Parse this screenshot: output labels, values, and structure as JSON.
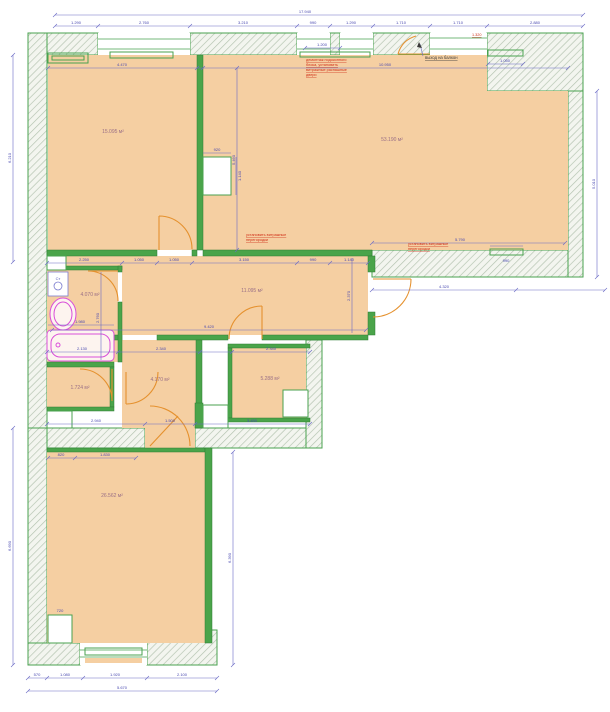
{
  "plan": {
    "colors": {
      "floor_fill": "#f5cfa2",
      "wall_green": "#49a24f",
      "dimension_blue": "#4848b0",
      "annotation_red": "#d03018",
      "fixture_magenta": "#d94fd9",
      "door_orange": "#e5912e"
    },
    "rooms": [
      {
        "id": "living-room-left",
        "area": "15.095 м²"
      },
      {
        "id": "living-room-right",
        "area": "53.190 м²"
      },
      {
        "id": "hall",
        "area": "11.095 м²"
      },
      {
        "id": "bathroom",
        "area": "4.070 м²"
      },
      {
        "id": "wc",
        "area": "1.724 м²"
      },
      {
        "id": "corridor",
        "area": "4.170 м²"
      },
      {
        "id": "pantry",
        "area": "5.288 м²"
      },
      {
        "id": "bedroom-bottom",
        "area": "26.562 м²"
      }
    ],
    "annotations": {
      "balcony_exit": "выход на балкон",
      "vitrage_line1": "установить витражные",
      "vitrage_line2": "перегородки",
      "demo_line1": "демонтаж подоконного",
      "demo_line2": "блока, установить",
      "demo_line3": "витражные распашные",
      "demo_line4": "двери",
      "red_dim": "1.320"
    },
    "fixtures": {
      "washing_machine": "Ст"
    },
    "dims": {
      "top_total": "17.940",
      "top_s1": "1.290",
      "top_s2": "2.760",
      "top_s3": "3.210",
      "top_s4": "990",
      "top_s5": "1.290",
      "top_s6": "1.710",
      "top_s7": "1.710",
      "top_s8": "2.880",
      "room_left_w": "4.470",
      "room_right_w": "10.950",
      "left_v": "6.210",
      "right_v": "5.010",
      "hall_s1": "2.250",
      "hall_s2": "1.050",
      "hall_s3": "1.050",
      "hall_s4": "3.150",
      "hall_s5": "990",
      "hall_s6": "1.140",
      "hall_w": "9.420",
      "hall_h": "2.370",
      "right_bottom": "4.320",
      "right_room_inner": "5.790",
      "right_niche": "990",
      "balcony_niche": "1.050",
      "balcony_blue": "1.200",
      "shaft_w": "920",
      "shaft_h": "1.140",
      "partition_v": "5.460",
      "mid_s1": "2.130",
      "mid_s2": "2.340",
      "mid_s3": "2.340",
      "low_s1": "2.940",
      "low_s2": "1.500",
      "low_s3": "3.450",
      "bottom_s1": "570",
      "bottom_s2": "1.080",
      "bottom_s3": "1.920",
      "bottom_s4": "2.100",
      "bottom_total": "5.670",
      "bottom_left_v": "6.690",
      "bottom_right_v": "6.390",
      "bath_h": "2.760",
      "tub_w": "1.980",
      "broom_s1": "820",
      "broom_s2": "1.830",
      "shaft5": "720"
    }
  }
}
